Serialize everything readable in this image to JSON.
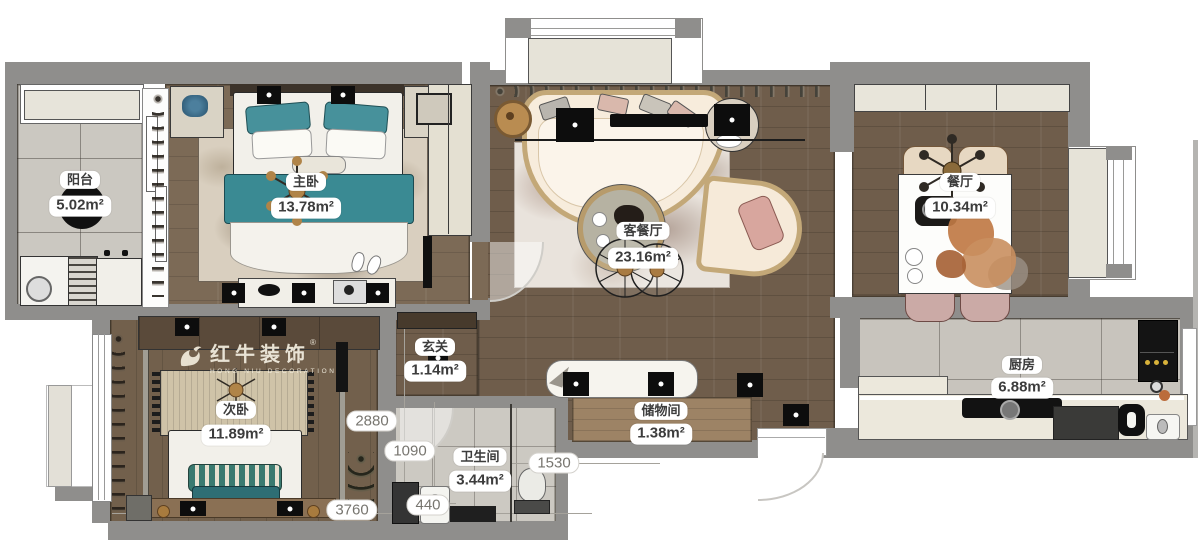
{
  "watermark": {
    "brand": "红牛装饰",
    "brand_en": "HONG NIU DECORATION",
    "reg": "®"
  },
  "rooms": [
    {
      "id": "balcony",
      "name": "阳台",
      "area": "5.02m²"
    },
    {
      "id": "master-bedroom",
      "name": "主卧",
      "area": "13.78m²"
    },
    {
      "id": "living-dining",
      "name": "客餐厅",
      "area": "23.16m²"
    },
    {
      "id": "dining-room",
      "name": "餐厅",
      "area": "10.34m²"
    },
    {
      "id": "second-bedroom",
      "name": "次卧",
      "area": "11.89m²"
    },
    {
      "id": "entry",
      "name": "玄关",
      "area": "1.14m²"
    },
    {
      "id": "bathroom",
      "name": "卫生间",
      "area": "3.44m²"
    },
    {
      "id": "storage",
      "name": "储物间",
      "area": "1.38m²"
    },
    {
      "id": "kitchen",
      "name": "厨房",
      "area": "6.88m²"
    }
  ],
  "dimensions": [
    {
      "id": "dim-2880",
      "value": "2880"
    },
    {
      "id": "dim-1090",
      "value": "1090"
    },
    {
      "id": "dim-3760",
      "value": "3760"
    },
    {
      "id": "dim-440",
      "value": "440"
    },
    {
      "id": "dim-1530",
      "value": "1530"
    }
  ],
  "colors": {
    "wall": "#8f8e8c",
    "wood_dark": "#6f5d4b",
    "wood_light": "#7c6a56",
    "tile": "#cbc8c1",
    "teal": "#3a8a93",
    "sofa_trim": "#c3a878"
  }
}
